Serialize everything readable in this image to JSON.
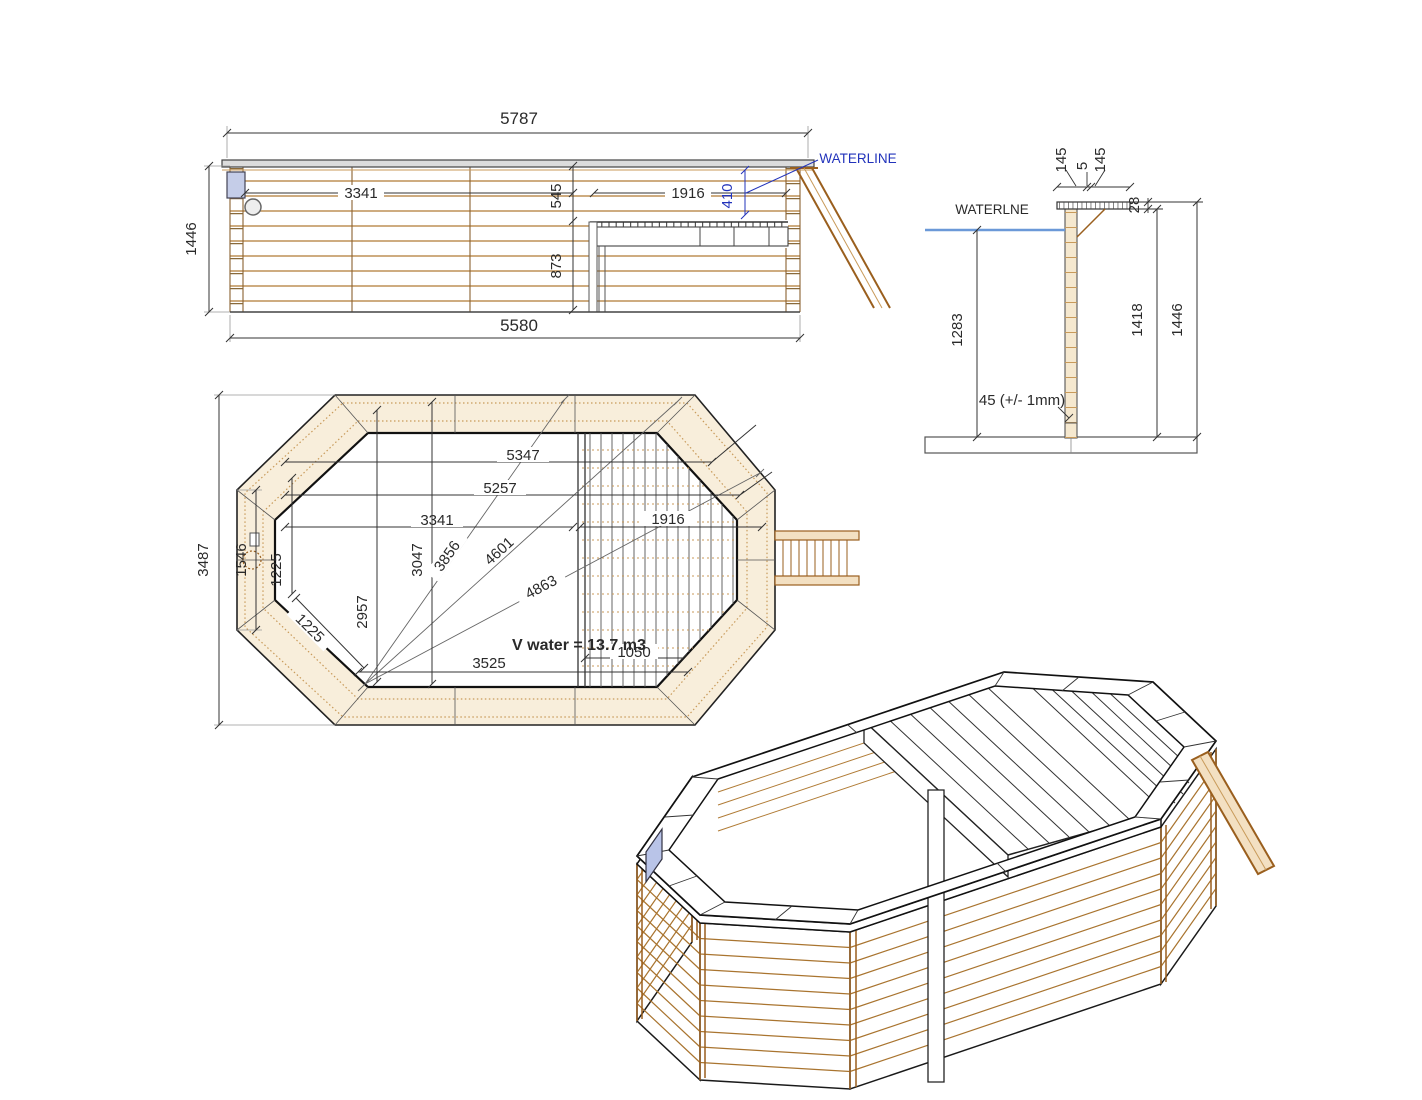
{
  "colors": {
    "dim_blue": "#2233bb",
    "waterline_blue": "#6b99d8",
    "wood": "#a9742f",
    "outline": "#222222"
  },
  "elevation": {
    "waterline_label": "WATERLINE",
    "dims": {
      "overall_width": "5787",
      "total_height": "1446",
      "left_span": "3341",
      "rim_drop": "545",
      "right_span": "1916",
      "waterline_drop": "410",
      "lower_drop": "873",
      "base_width": "5580"
    }
  },
  "section": {
    "waterline_label": "WATERLNE",
    "note_floor": "45 (+/- 1mm)",
    "dims": {
      "coping_outer": "145",
      "coping_gap": "5",
      "coping_inner": "145",
      "coping_thickness": "28",
      "water_depth": "1283",
      "wall_height": "1418",
      "overall_height": "1446"
    }
  },
  "plan": {
    "volume_label": "V water = 13.7 m3",
    "dims": {
      "diag_long": "5347",
      "diag_second": "5257",
      "span_left": "3341",
      "span_deck": "1916",
      "overall_width": "3487",
      "side_panel": "1546",
      "inner_width": "3047",
      "inner_width_b": "2957",
      "corner_offset": "1225",
      "corner_edge": "1225",
      "ray_short": "3856",
      "ray_mid": "4601",
      "ray_long": "4863",
      "deck_strip": "1050",
      "floor_span": "3525"
    }
  }
}
